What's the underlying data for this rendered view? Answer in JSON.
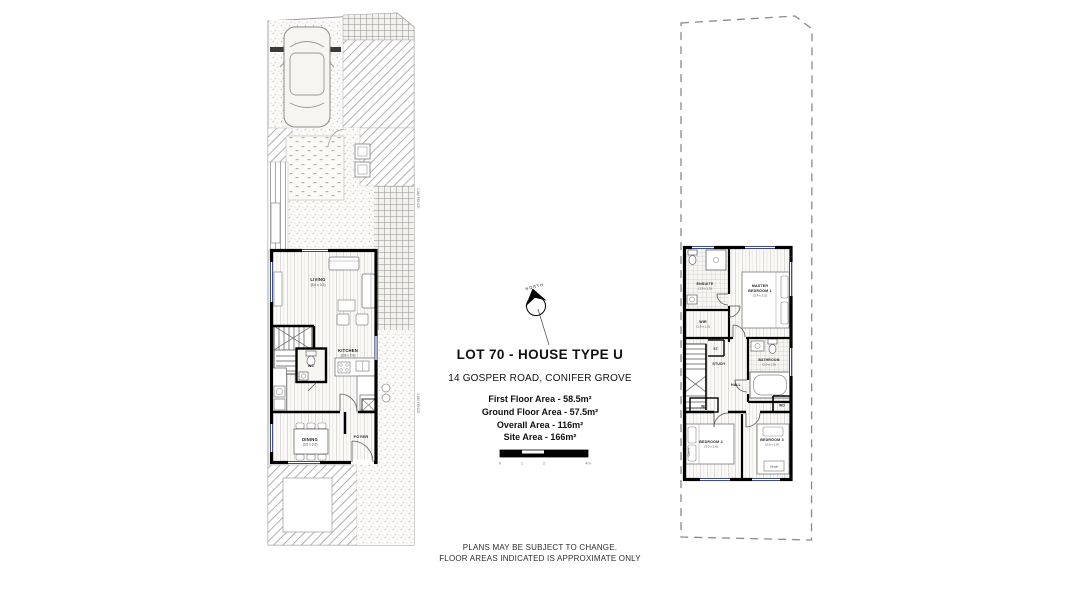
{
  "title_block": {
    "title": "LOT 70 - HOUSE TYPE U",
    "address": "14 GOSPER ROAD, CONIFER GROVE",
    "areas": [
      "First Floor Area - 58.5m²",
      "Ground Floor Area - 57.5m²",
      "Overall Area - 116m²",
      "Site Area - 166m²"
    ]
  },
  "north_arrow": {
    "label": "NORTH"
  },
  "scale_bar": {
    "ticks": [
      "0",
      "1",
      "2",
      "4m"
    ]
  },
  "disclaimer": {
    "line1": "PLANS MAY BE SUBJECT TO CHANGE.",
    "line2": "FLOOR AREAS INDICATED IS APPROXIMATE ONLY"
  },
  "ground_floor": {
    "rooms": {
      "living": {
        "name": "LIVING",
        "dims": "(5.6 x 3.3)"
      },
      "kitchen": {
        "name": "KITCHEN",
        "dims": "(3.8 x 2.0)"
      },
      "dining": {
        "name": "DINING",
        "dims": "(3.5 x 3.0)"
      },
      "foyer": {
        "name": "FOYER"
      },
      "wc": {
        "name": "WC"
      }
    },
    "fence_labels": [
      "1.8M FENCE",
      "1.8M FENCE"
    ]
  },
  "first_floor": {
    "rooms": {
      "ensuite": {
        "name": "ENSUITE",
        "dims": "(1.9 x 1.5)"
      },
      "master_bedroom": {
        "line1": "MASTER",
        "line2": "BEDROOM 1",
        "dims": "(3.4 x 3.3)"
      },
      "wir": {
        "name": "WIR",
        "dims": "(1.9 x 1.2)"
      },
      "store": {
        "name": "ST."
      },
      "study": {
        "name": "STUDY"
      },
      "hall": {
        "name": "HALL"
      },
      "bathroom": {
        "name": "BATHROOM",
        "dims": "(2.0 x 1.9)"
      },
      "wardrobe_left": {
        "name": "WD"
      },
      "wardrobe_right": {
        "name": "WD"
      },
      "bedroom2": {
        "name": "BEDROOM 2",
        "dims": "(3.0 x 2.6)",
        "bed": "Queen"
      },
      "bedroom3": {
        "name": "BEDROOM 3",
        "dims": "(2.6 x 1.9)",
        "bed": "Single"
      }
    }
  },
  "colors": {
    "wall": "#000000",
    "hatch": "#a3a3a3",
    "window_mark": "#23306e",
    "boundary": "#8a8a8a"
  }
}
